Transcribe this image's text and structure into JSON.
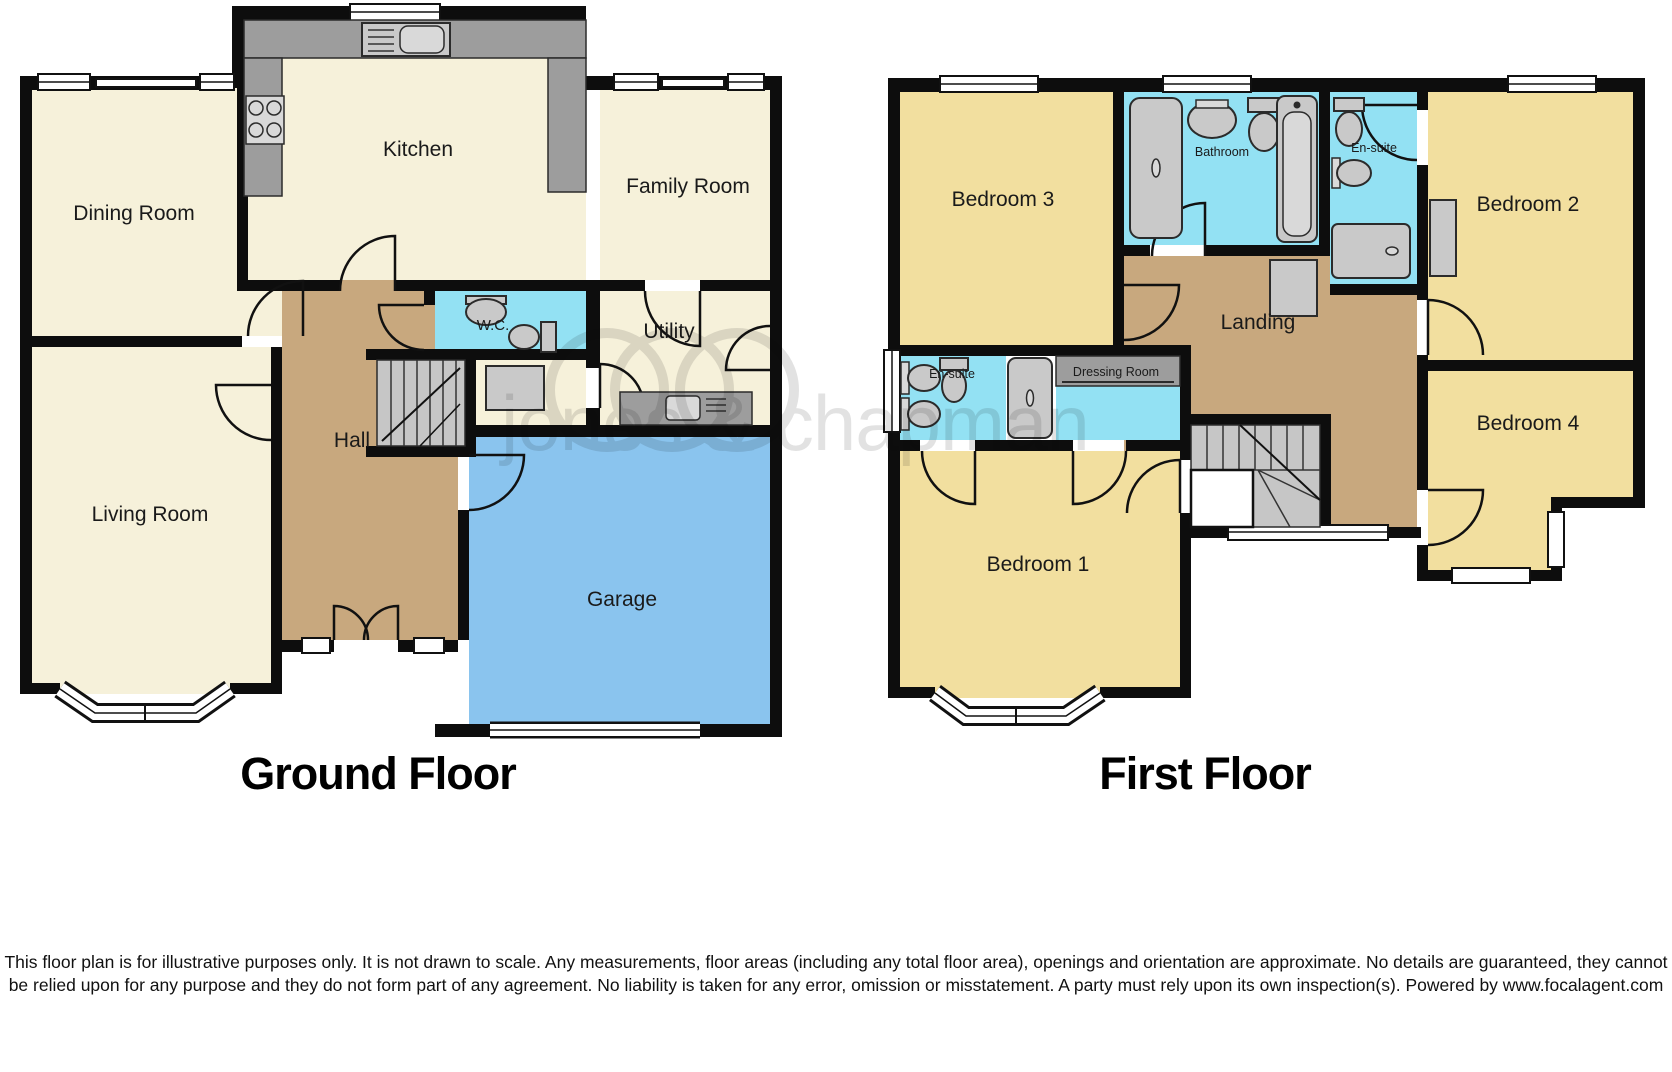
{
  "watermark": {
    "brand": "jones & chapman"
  },
  "ground_floor": {
    "title": "Ground Floor",
    "rooms": {
      "dining": "Dining Room",
      "kitchen": "Kitchen",
      "family": "Family Room",
      "wc": "W.C.",
      "utility": "Utility",
      "hall": "Hall",
      "living": "Living Room",
      "garage": "Garage"
    }
  },
  "first_floor": {
    "title": "First Floor",
    "rooms": {
      "bedroom3": "Bedroom 3",
      "bathroom": "Bathroom",
      "ensuite2": "En-suite",
      "bedroom2": "Bedroom 2",
      "ensuite1": "En-suite",
      "dressing": "Dressing Room",
      "landing": "Landing",
      "bedroom4": "Bedroom 4",
      "bedroom1": "Bedroom 1"
    }
  },
  "disclaimer": "This floor plan is for illustrative purposes only. It is not drawn to scale. Any measurements, floor areas (including any total floor area), openings and orientation are approximate. No details are guaranteed, they cannot be relied upon for any purpose and they do not form part of any agreement. No liability is taken for any error, omission or misstatement. A party must rely upon its own inspection(s). Powered by www.focalagent.com",
  "colors": {
    "wall": "#0d0d0d",
    "cream": "#f6f1da",
    "yellow": "#f2df9f",
    "tan": "#c8a87e",
    "blue": "#93e1f3",
    "garage": "#8ac4ee",
    "fixture": "#c9c9c9",
    "counter": "#9d9d9d",
    "stairs": "#c6c6c6",
    "watermark": "#c6c6c6"
  }
}
